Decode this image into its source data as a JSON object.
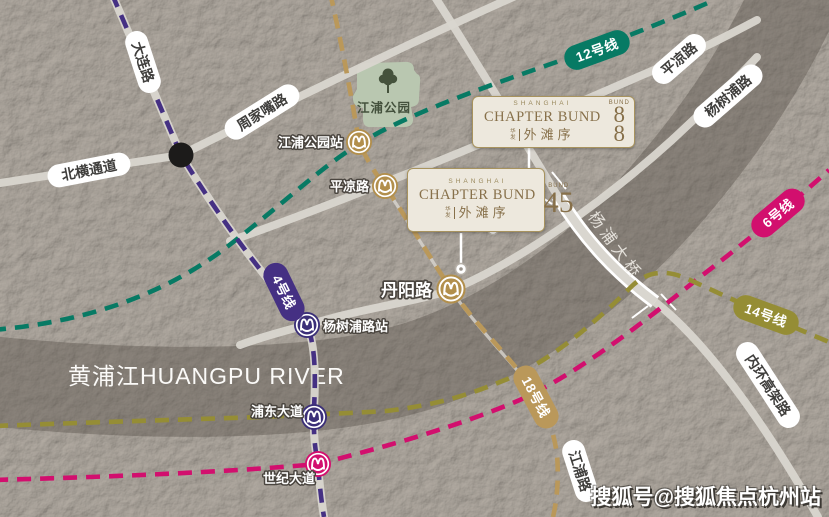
{
  "watermark": {
    "text": "搜狐号@搜狐焦点杭州站"
  },
  "river": {
    "label": "黄浦江HUANGPU RIVER"
  },
  "bridge": {
    "label": "杨浦大桥"
  },
  "park": {
    "label": "江浦公园"
  },
  "road_labels": [
    {
      "text": "大连路"
    },
    {
      "text": "周家嘴路"
    },
    {
      "text": "北横通道"
    },
    {
      "text": "平凉路"
    },
    {
      "text": "杨树浦路"
    },
    {
      "text": "内环高架路"
    },
    {
      "text": "江浦路"
    }
  ],
  "metro_lines": [
    {
      "name": "12号线",
      "color": "#077a64"
    },
    {
      "name": "6号线",
      "color": "#d20f6e"
    },
    {
      "name": "4号线",
      "color": "#453083"
    },
    {
      "name": "14号线",
      "color": "#958d35"
    },
    {
      "name": "18号线",
      "color": "#ba985a"
    }
  ],
  "stations": [
    {
      "name": "江浦公园站",
      "color": "#b28f4c"
    },
    {
      "name": "平凉路",
      "color": "#b28f4c"
    },
    {
      "name": "丹阳路",
      "color": "#b28f4c"
    },
    {
      "name": "杨树浦路站",
      "color": "#3b2f78"
    },
    {
      "name": "浦东大道",
      "color": "#3b2f78"
    },
    {
      "name": "世纪大道",
      "color": "#d20f6e"
    }
  ],
  "cards": [
    {
      "brand_top": "SHANGHAI",
      "brand_main": "CHAPTER BUND",
      "prefix_chars": [
        "华",
        "发"
      ],
      "brand_cn": "外滩序",
      "bund_label": "BUND",
      "digits": [
        "8",
        "8"
      ]
    },
    {
      "brand_top": "SHANGHAI",
      "brand_main": "CHAPTER BUND",
      "prefix_chars": [
        "华",
        "发"
      ],
      "brand_cn": "外滩序",
      "bund_label": "BUND",
      "digits": [
        "4",
        "5"
      ]
    }
  ]
}
